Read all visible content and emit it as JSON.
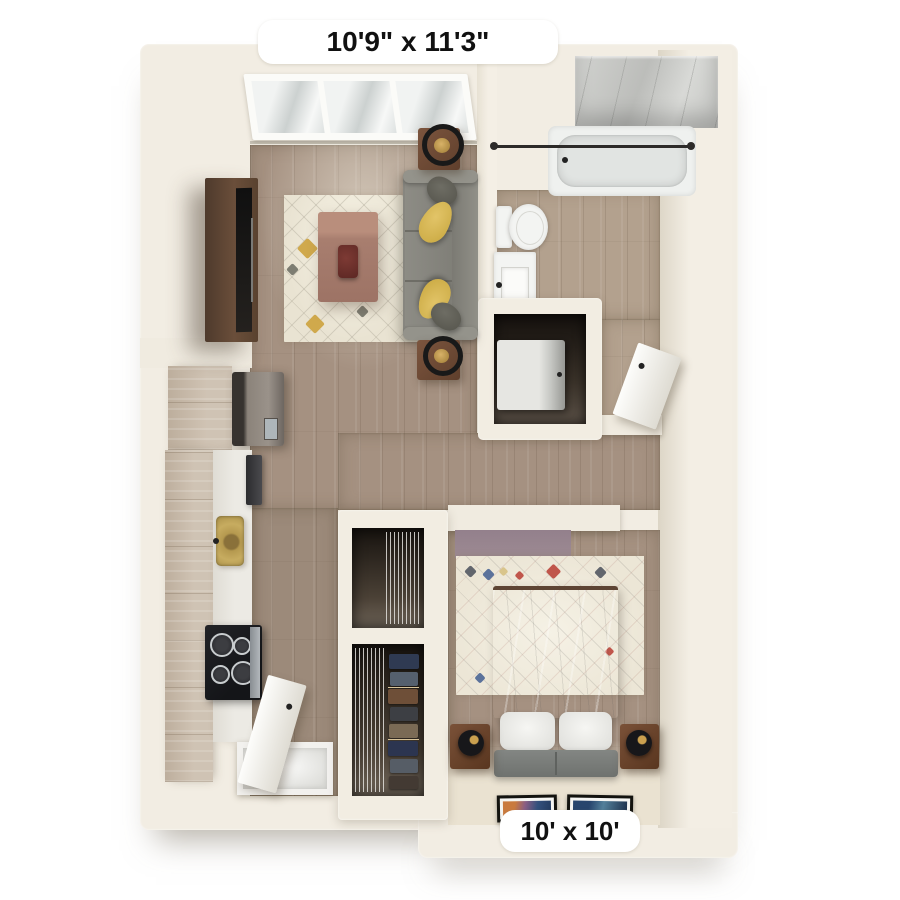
{
  "labels": {
    "living_room_dimensions": "10'9\" x 11'3\"",
    "bedroom_dimensions": "10' x 10'"
  },
  "colors": {
    "background": "#ffffff",
    "walls": "#f2ede3",
    "wood_floor": "#a59181",
    "bathroom_floor": "#b3a18e",
    "marble_shower": "#c7c8c5",
    "sofa_gray": "#87867f",
    "pillow_yellow": "#d0a94c",
    "cabinet_wood": "#cabcab",
    "gold_sink": "#b5994f",
    "rug_cream": "#ece6d6",
    "label_background": "#ffffff",
    "label_text": "#111111"
  }
}
